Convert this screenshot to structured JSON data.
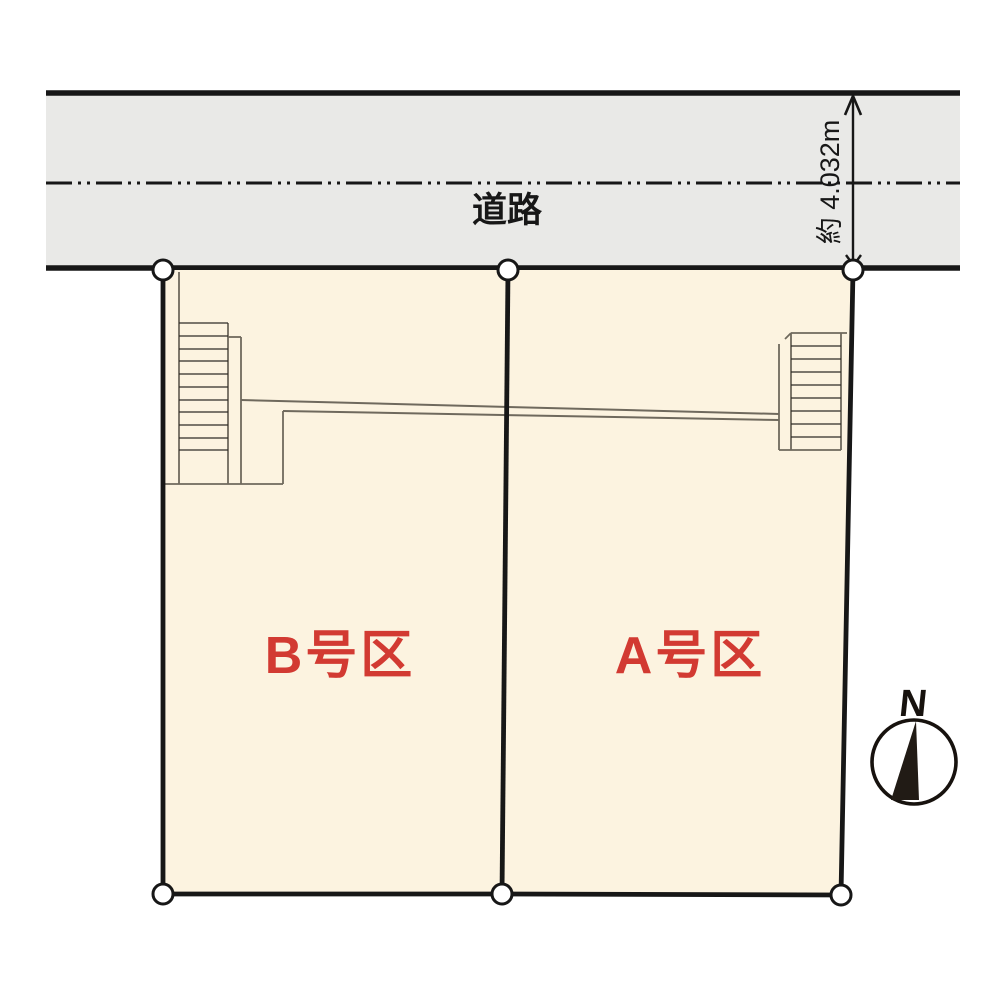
{
  "diagram": {
    "type": "land-plot-layout",
    "road": {
      "label": "道路",
      "width_label": "約 4.032m"
    },
    "plots": [
      {
        "id": "B",
        "label": "B号区"
      },
      {
        "id": "A",
        "label": "A号区"
      }
    ],
    "compass": {
      "label": "N"
    },
    "colors": {
      "road_fill": "#e9e9e7",
      "plot_fill": "#fcf3e0",
      "label_red": "#d23a32",
      "line_black": "#171717",
      "structure_gray": "#6f695d",
      "needle_black": "#211b15"
    }
  }
}
